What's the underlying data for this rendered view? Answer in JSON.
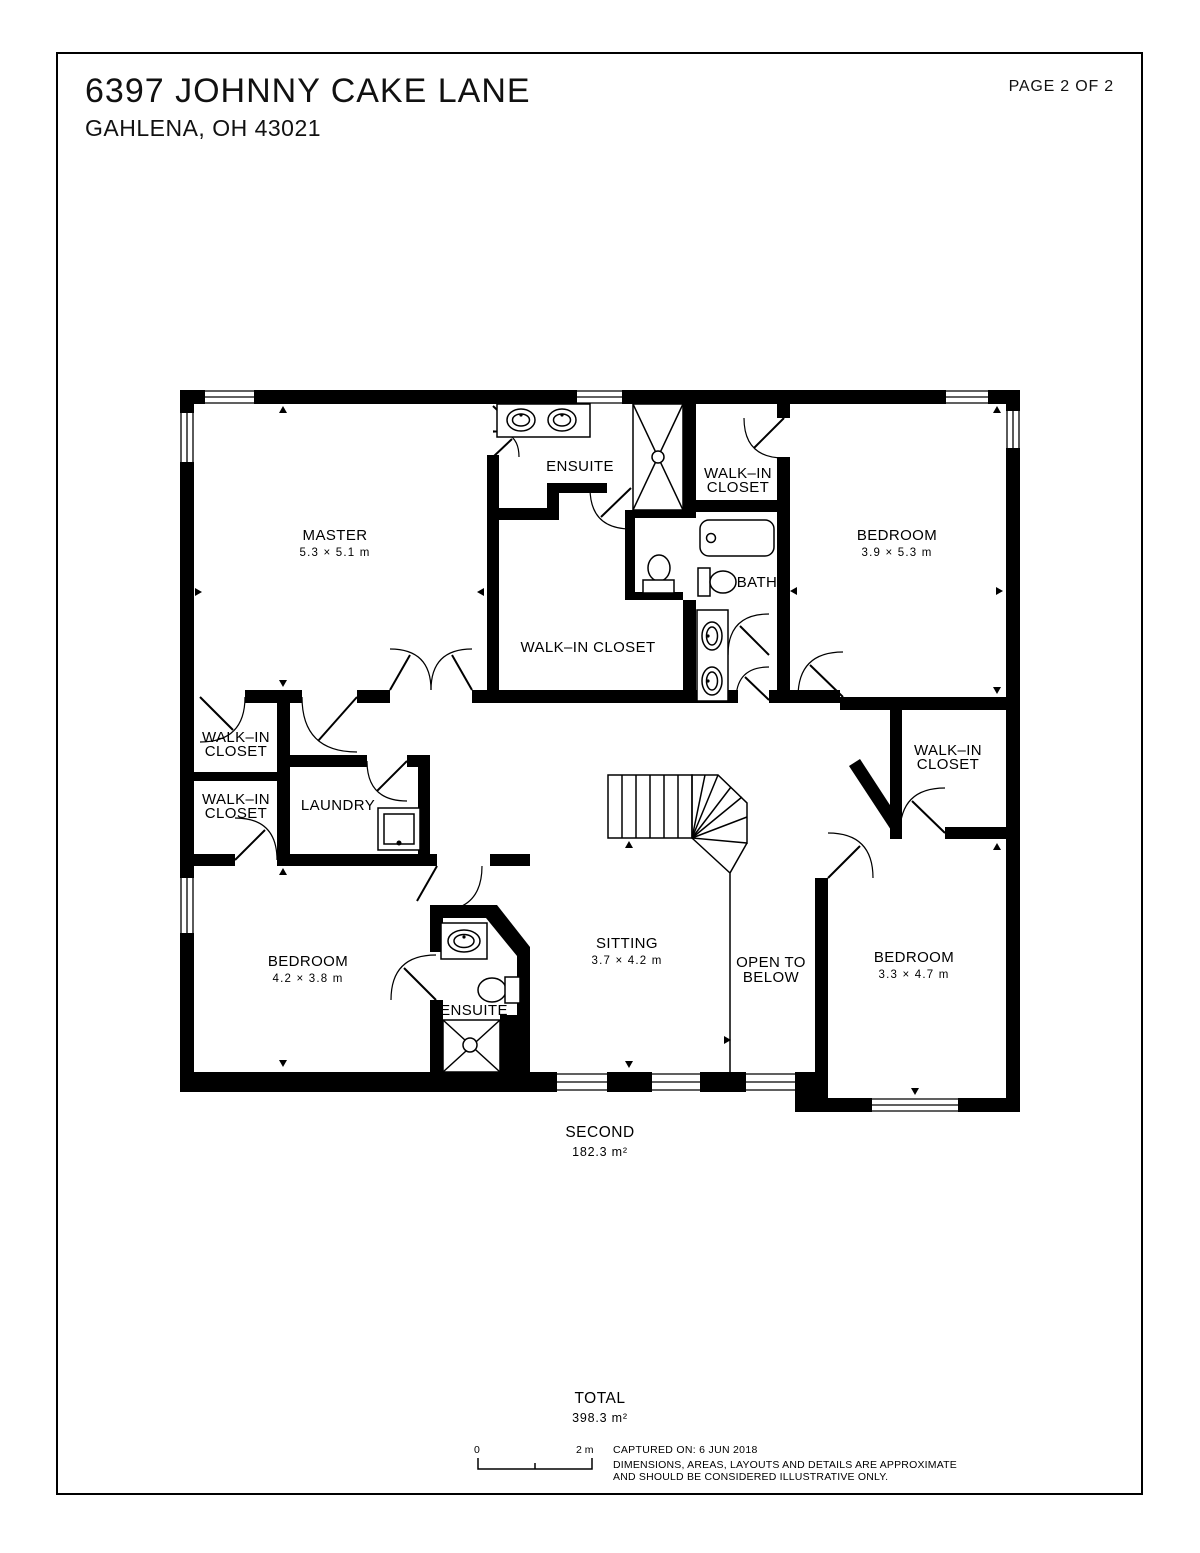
{
  "header": {
    "address_line1": "6397 JOHNNY CAKE LANE",
    "address_line2": "GAHLENA, OH 43021",
    "page_label": "PAGE 2 OF 2"
  },
  "floor": {
    "name": "SECOND",
    "area": "182.3 m²"
  },
  "total": {
    "label": "TOTAL",
    "area": "398.3 m²"
  },
  "scale_bar": {
    "start_label": "0",
    "end_label": "2 m"
  },
  "footer": {
    "captured_on": "CAPTURED ON: 6 JUN 2018",
    "disclaimer_line1": "DIMENSIONS, AREAS, LAYOUTS AND DETAILS ARE APPROXIMATE",
    "disclaimer_line2": "AND SHOULD BE CONSIDERED ILLUSTRATIVE ONLY."
  },
  "rooms": {
    "master": {
      "name": "MASTER",
      "dims": "5.3 × 5.1 m"
    },
    "ensuite_top": {
      "name": "ENSUITE"
    },
    "wic_top_right": {
      "line1": "WALK–IN",
      "line2": "CLOSET"
    },
    "bath": {
      "name": "BATH"
    },
    "bedroom_tr": {
      "name": "BEDROOM",
      "dims": "3.9 × 5.3 m"
    },
    "wic_master": {
      "name": "WALK–IN CLOSET"
    },
    "wic_left_1": {
      "line1": "WALK–IN",
      "line2": "CLOSET"
    },
    "wic_left_2": {
      "line1": "WALK–IN",
      "line2": "CLOSET"
    },
    "laundry": {
      "name": "LAUNDRY"
    },
    "bedroom_bl": {
      "name": "BEDROOM",
      "dims": "4.2 × 3.8 m"
    },
    "ensuite_bottom": {
      "name": "ENSUITE"
    },
    "sitting": {
      "name": "SITTING",
      "dims": "3.7 × 4.2 m"
    },
    "open_to_below": {
      "line1": "OPEN TO",
      "line2": "BELOW"
    },
    "wic_right": {
      "line1": "WALK–IN",
      "line2": "CLOSET"
    },
    "bedroom_br": {
      "name": "BEDROOM",
      "dims": "3.3 × 4.7 m"
    }
  },
  "colors": {
    "ink": "#000000",
    "paper": "#ffffff"
  }
}
